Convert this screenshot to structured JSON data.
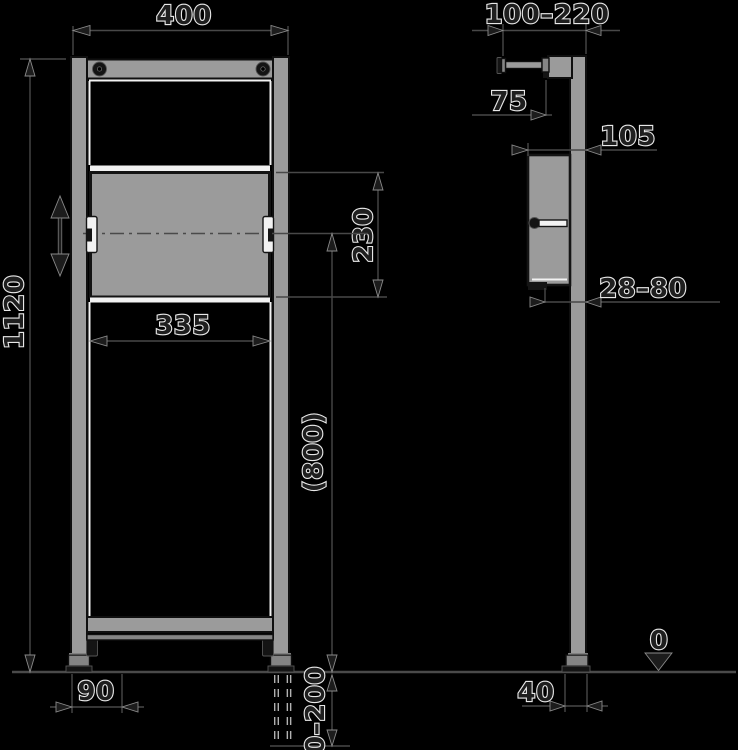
{
  "drawing": {
    "description_labels": {},
    "dimensions": {
      "front": {
        "frame_width": "400",
        "frame_height": "1120",
        "panel_width": "335",
        "panel_height": "230",
        "axis_height": "(800)",
        "foot_span": "90",
        "leg_extension": "0–200"
      },
      "side": {
        "wall_distance_range": "100–220",
        "anchor_offset": "75",
        "frame_depth": "105",
        "rear_gap_range": "28–80",
        "foot_depth": "40",
        "floor_level": "0"
      }
    },
    "colors": {
      "background": "#000000",
      "dimension_line": "#484848",
      "metal_fill": "#9b9b9b",
      "metal_dark": "#858585",
      "highlight_white": "#f2f2f2",
      "dark_part": "#141414",
      "text_outline": "#e8e8e8",
      "text_fill": "#1f1f1f"
    }
  }
}
